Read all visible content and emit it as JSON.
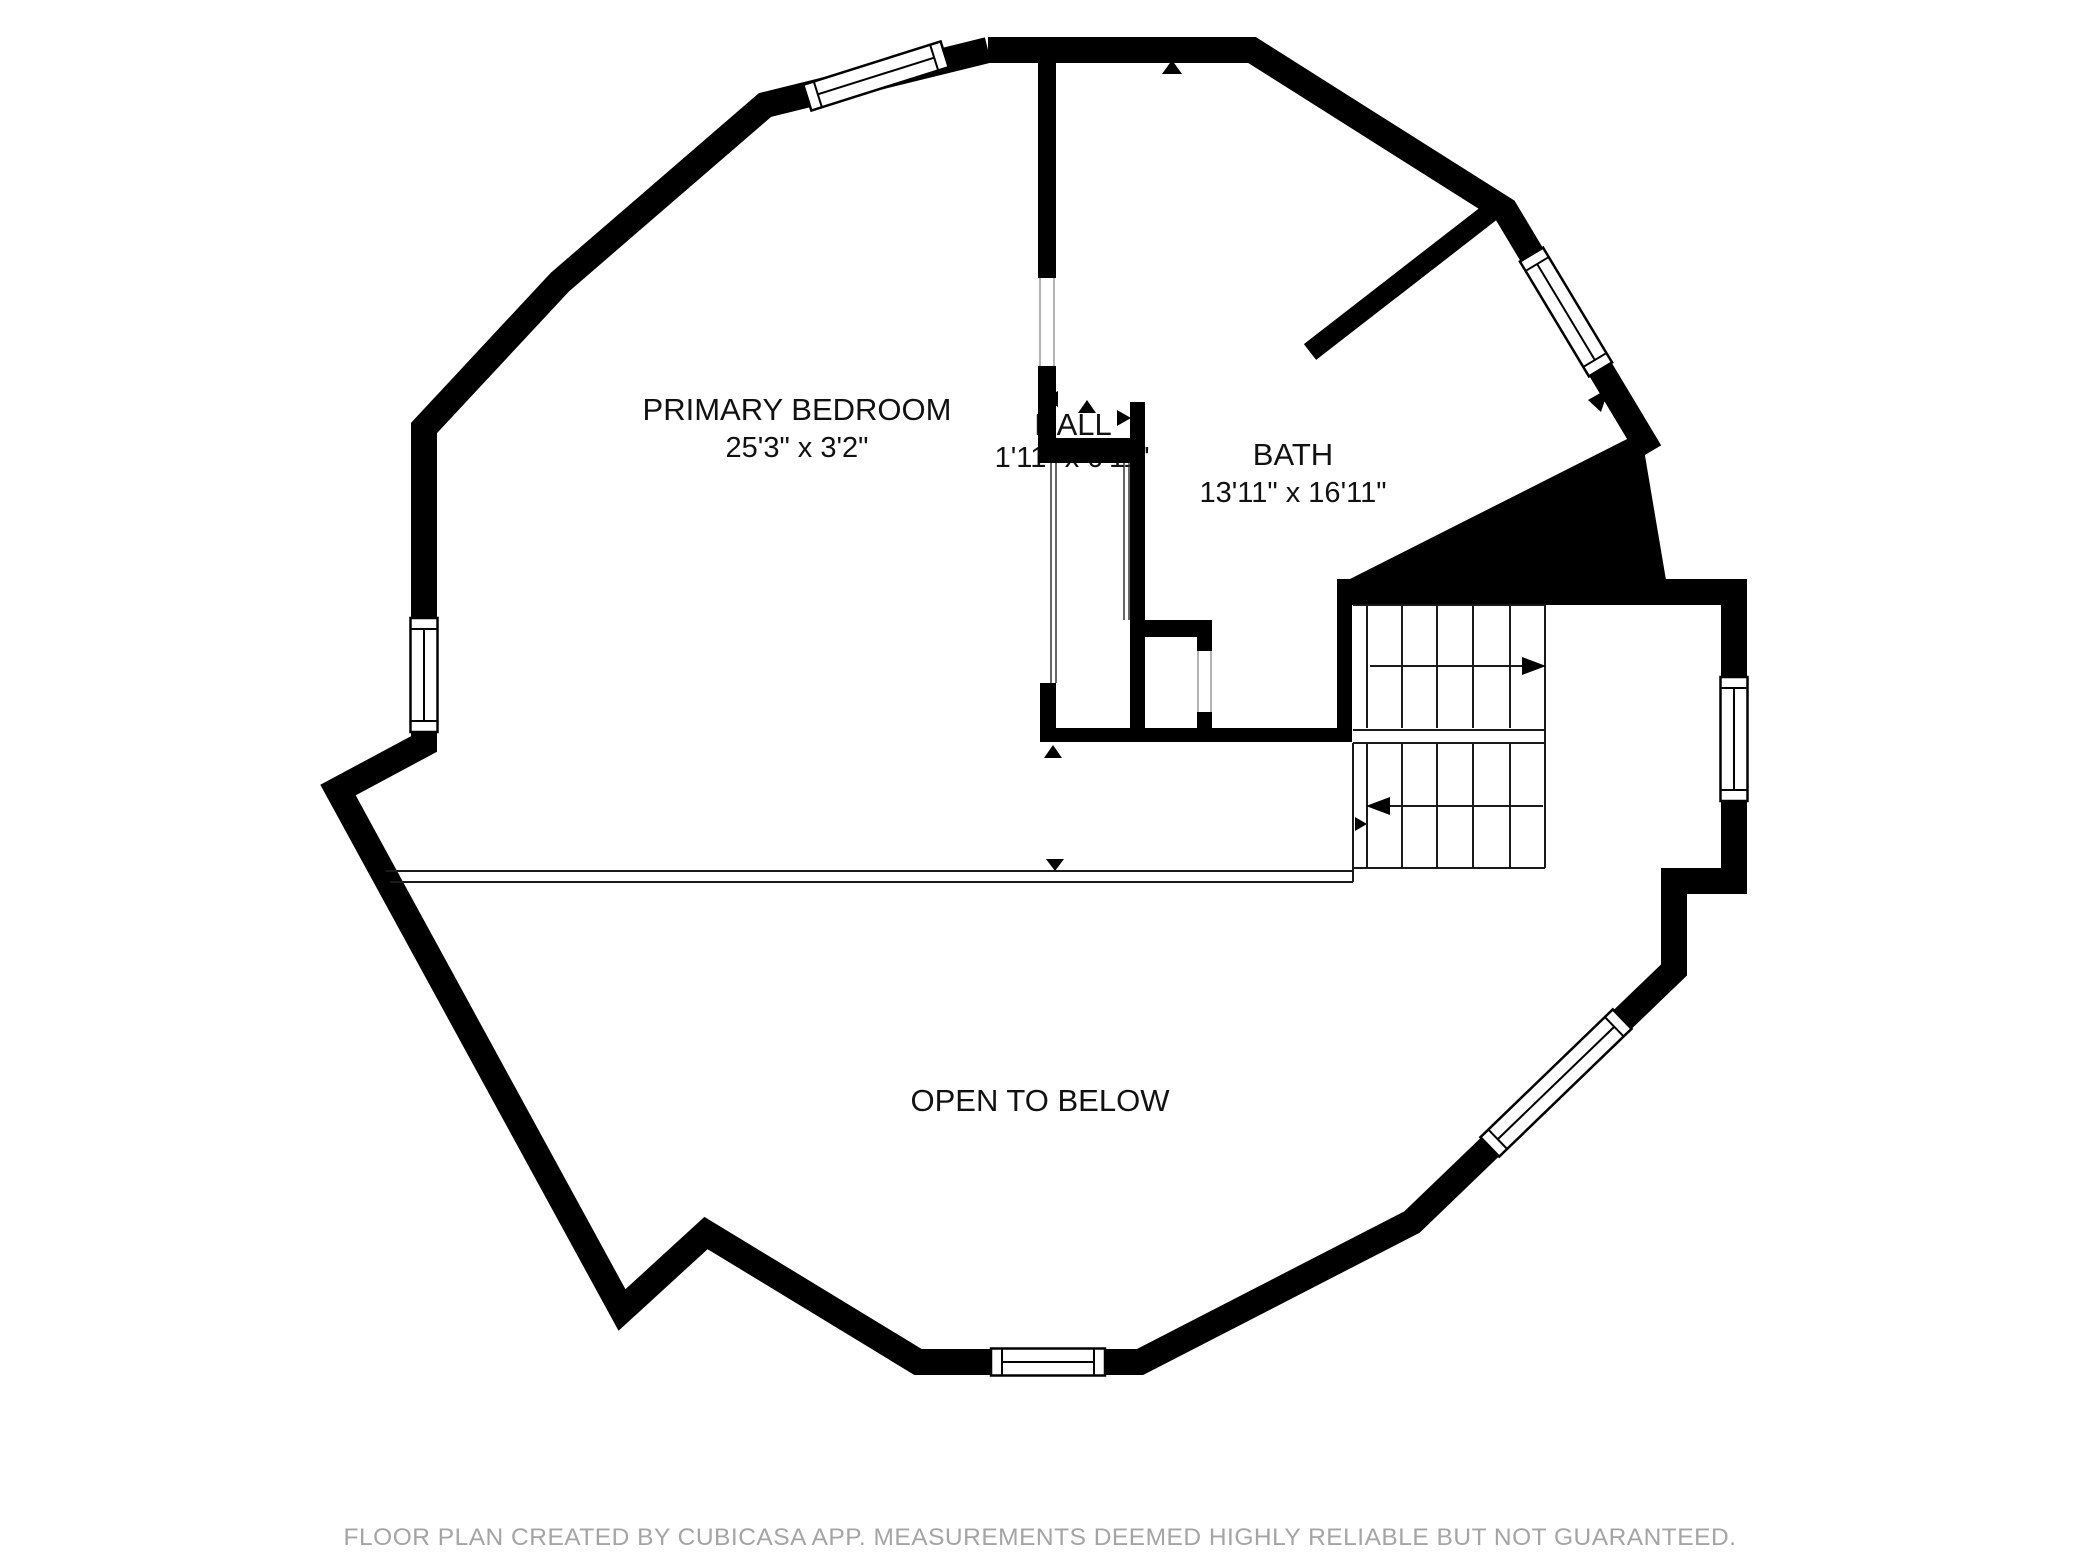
{
  "title": "Second floor plan",
  "rooms": [
    {
      "name": "PRIMARY BEDROOM",
      "dims": "25'3\" x 3'2\""
    },
    {
      "name": "HALL",
      "dims": "1'11\" x 0'11\""
    },
    {
      "name": "BATH",
      "dims": "13'11\" x 16'11\""
    },
    {
      "name": "OPEN TO BELOW",
      "dims": ""
    }
  ],
  "footer": {
    "disclaimer": "FLOOR PLAN CREATED BY CUBICASA APP. MEASUREMENTS DEEMED HIGHLY RELIABLE BUT NOT GUARANTEED."
  },
  "colors": {
    "wall": "#000000",
    "label": "#111111",
    "disclaimer": "#a4a4a4"
  }
}
